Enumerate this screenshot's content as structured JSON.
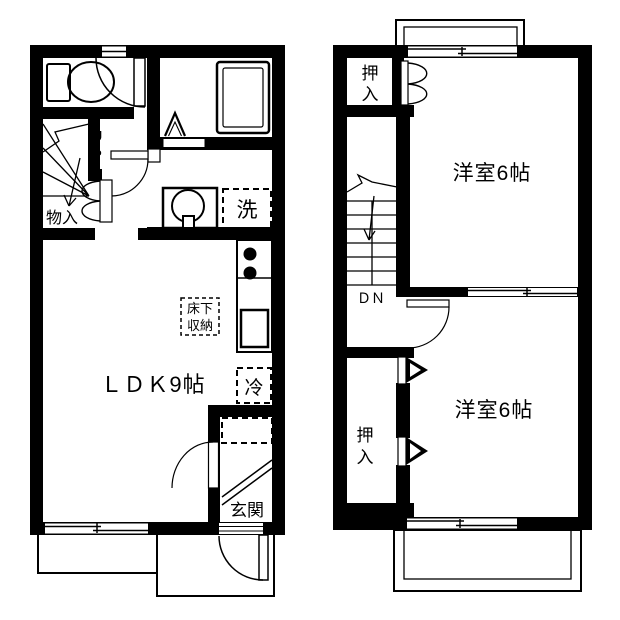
{
  "plan": {
    "floor1": {
      "ldk_label": "ＬＤＫ9帖",
      "genkan_label": "玄関",
      "monoire_label": "物入",
      "washer_label": "洗",
      "fridge_label": "冷",
      "underfloor_line1": "床下",
      "underfloor_line2": "収納",
      "up_line1": "U",
      "up_line2": "P"
    },
    "floor2": {
      "bedroom_top_label": "洋室6帖",
      "bedroom_bottom_label": "洋室6帖",
      "closet_top_line1": "押",
      "closet_top_line2": "入",
      "closet_bottom_line1": "押",
      "closet_bottom_line2": "入",
      "dn_label": "ＤＮ"
    },
    "colors": {
      "wall": "#000000",
      "background": "#ffffff"
    }
  }
}
